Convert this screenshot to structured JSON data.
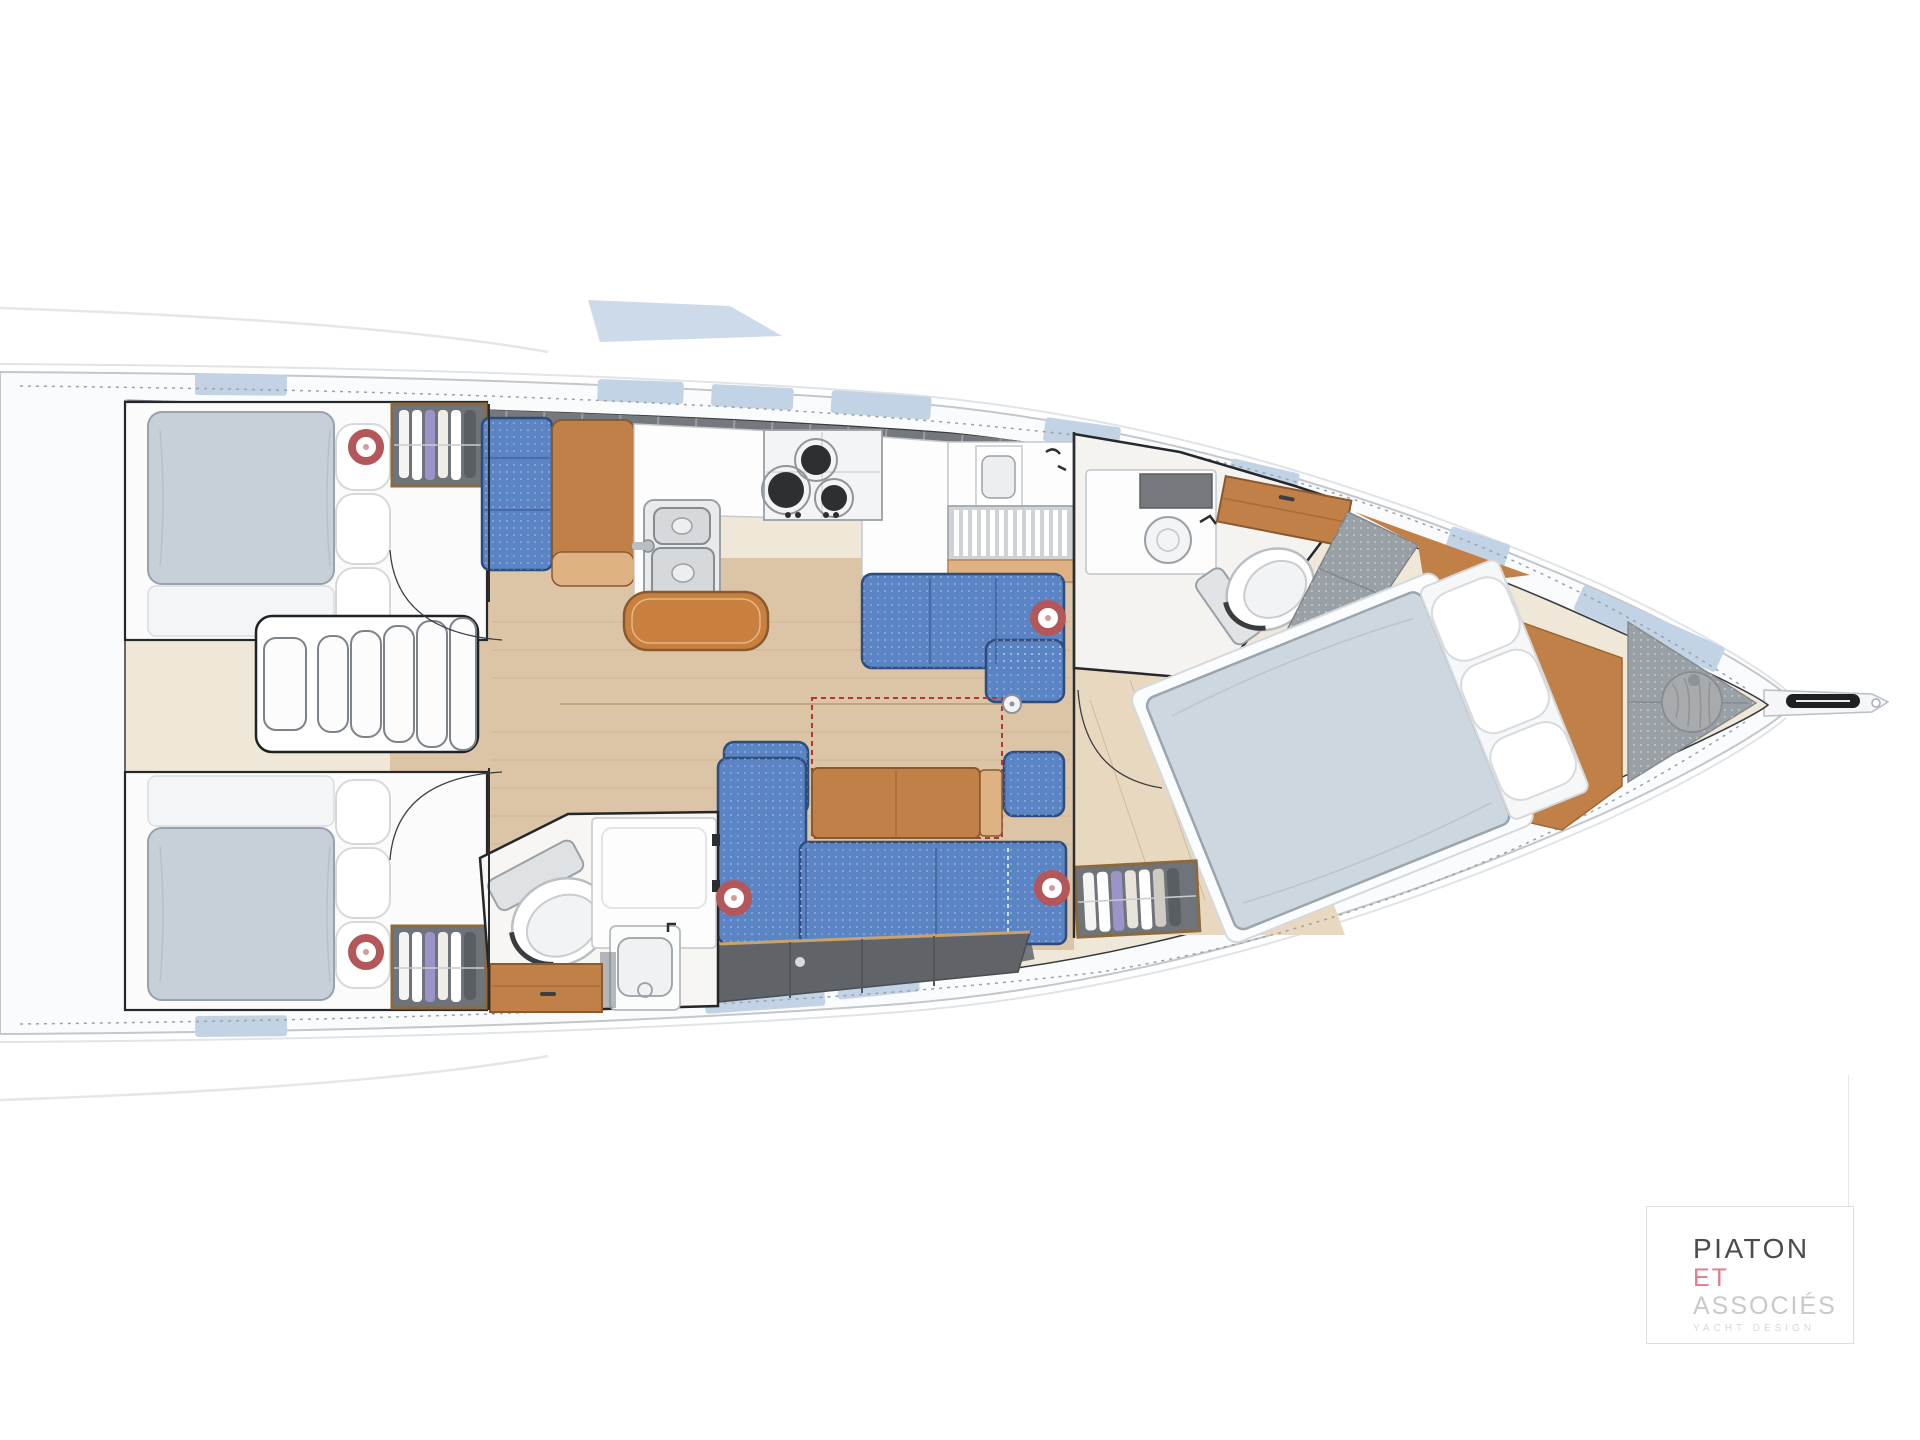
{
  "logo": {
    "line1": "PIATON",
    "line2": "ET",
    "line3": "ASSOCIÉS",
    "tagline": "YACHT DESIGN"
  },
  "colors": {
    "paper": "#ffffff",
    "hullFill": "#fafbfc",
    "hullLine": "#c2c7cb",
    "flare": "#e0e4e7",
    "innerFill": "#efe7d8",
    "innerLine": "#36393d",
    "gunwale": "#75797d",
    "hatchBlue": "#c3d3e6",
    "floor": "#dcc5a7",
    "floorSeam": "#c2a985",
    "foreFloor": "#e8d8bf",
    "wood": "#c28049",
    "woodDark": "#8a5a2e",
    "woodLight": "#dfb284",
    "upholstery": "#5b84c4",
    "upholsteryEdge": "#2e4d7d",
    "mattress": "#c7d0d9",
    "mattressEdge": "#97a2ac",
    "pillow": "#ffffff",
    "pillowEdge": "#d5d9dc",
    "furnWhite": "#fdfdfe",
    "furnLine": "#c6c9cd",
    "steel": "#9aa0a5",
    "lockerDark": "#606468",
    "grayPad": "#9aa1a6",
    "marker": "#b4575a",
    "logoDark": "#4b4b4f",
    "logoPink": "#e8788a",
    "logoGray": "#c9c9cd",
    "logoFaint": "#d8d8db"
  },
  "hatch_markers": [
    {
      "x": 366,
      "y": 447
    },
    {
      "x": 366,
      "y": 952
    },
    {
      "x": 1048,
      "y": 618
    },
    {
      "x": 734,
      "y": 898
    },
    {
      "x": 1052,
      "y": 888
    }
  ],
  "deck_hatches": [
    {
      "x": 195,
      "y": 374,
      "w": 92,
      "h": 21,
      "r": 0.5
    },
    {
      "x": 598,
      "y": 379,
      "w": 86,
      "h": 22,
      "r": 2
    },
    {
      "x": 712,
      "y": 384,
      "w": 82,
      "h": 22,
      "r": 3
    },
    {
      "x": 832,
      "y": 390,
      "w": 100,
      "h": 23,
      "r": 4
    },
    {
      "x": 1046,
      "y": 417,
      "w": 76,
      "h": 24,
      "r": 8
    },
    {
      "x": 1232,
      "y": 458,
      "w": 70,
      "h": 25,
      "r": 13
    },
    {
      "x": 1452,
      "y": 526,
      "w": 62,
      "h": 25,
      "r": 18
    },
    {
      "x": 1584,
      "y": 585,
      "w": 155,
      "h": 27,
      "r": 24
    },
    {
      "x": 195,
      "y": 1016,
      "w": 92,
      "h": 21,
      "r": -0.5
    },
    {
      "x": 704,
      "y": 990,
      "w": 120,
      "h": 24,
      "r": -4
    },
    {
      "x": 836,
      "y": 976,
      "w": 82,
      "h": 24,
      "r": -6
    },
    {
      "x": 1290,
      "y": 880,
      "w": 104,
      "h": 28,
      "r": -17
    },
    {
      "x": 1468,
      "y": 812,
      "w": 58,
      "h": 26,
      "r": -21
    }
  ]
}
